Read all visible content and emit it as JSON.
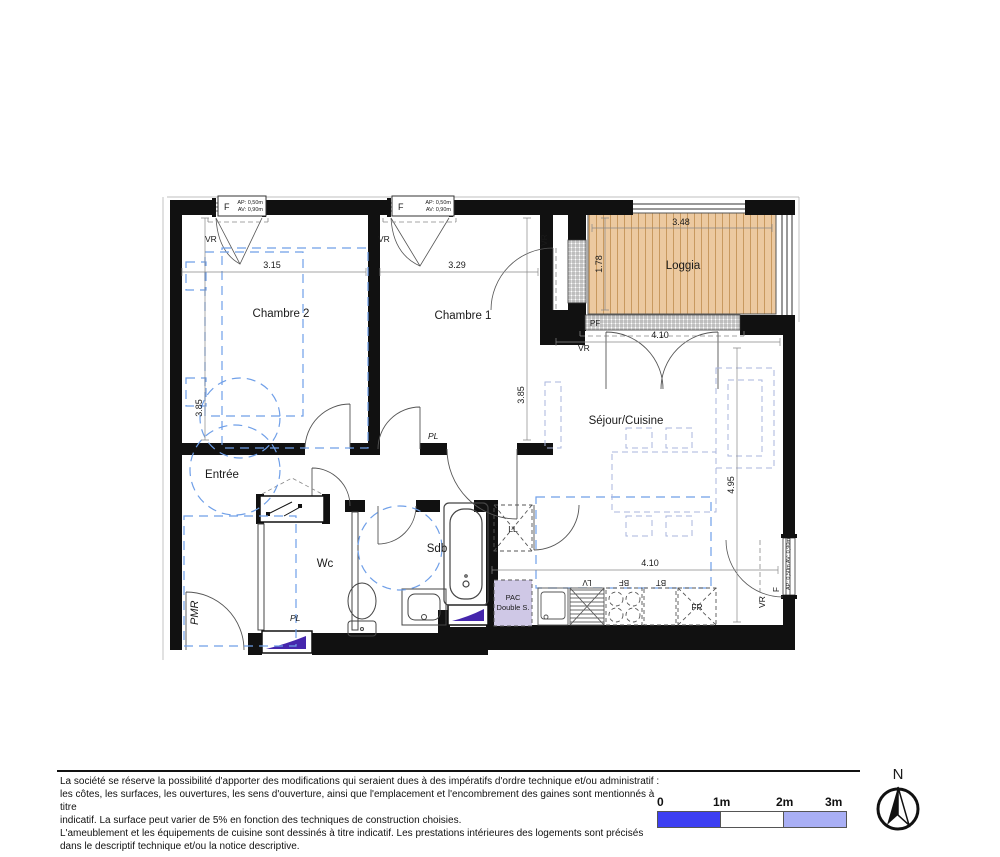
{
  "rooms": {
    "chambre2": "Chambre 2",
    "chambre1": "Chambre 1",
    "loggia": "Loggia",
    "sejour": "Séjour/Cuisine",
    "entree": "Entrée",
    "wc": "Wc",
    "sdb": "Sdb",
    "pmr": "PMR"
  },
  "labels": {
    "pl1": "PL",
    "pl2": "PL",
    "pf": "PF",
    "pac_line1": "PAC",
    "pac_line2": "Double S."
  },
  "appliances": {
    "ll": "LL",
    "lv": "LV",
    "bf": "BF",
    "bt": "BT",
    "fr": "FR"
  },
  "windows": {
    "f": "F",
    "ap": "AP: 0,50m",
    "av": "AV: 0,90m",
    "vr": "VR",
    "side_f": "F",
    "side_spec": "AP: 0,50m AV: 0,90m"
  },
  "dimensions": {
    "chambre2_w": "3.15",
    "chambre1_w": "3.29",
    "chambre2_h": "3.85",
    "chambre1_h": "3.85",
    "loggia_w": "3.48",
    "loggia_h": "1.78",
    "sejour_w": "4.10",
    "sejour_h": "4.95",
    "kitchen_w": "4.10"
  },
  "compass": {
    "north": "N"
  },
  "scalebar": {
    "labels": [
      "0",
      "1m",
      "2m",
      "3m"
    ]
  },
  "colors": {
    "wall": "#111111",
    "wood": "#ecc9a0",
    "wood_stripe": "#c8995f",
    "accent_purple": "#4526ad",
    "pac_fill": "#cfc8e6",
    "dash_blue": "#6f9fe8",
    "furn_dash": "#aab6dd",
    "scale_blue": "#3d3ff2",
    "scale_white": "#ffffff",
    "scale_light": "#a9aff5"
  },
  "disclaimer": {
    "lines": [
      "La société se réserve la possibilité d'apporter des modifications qui seraient dues à des impératifs d'ordre technique et/ou administratif :",
      "les côtes, les surfaces, les ouvertures, les sens d'ouverture, ainsi que l'emplacement et l'encombrement des gaines sont mentionnés à titre",
      "indicatif. La surface peut varier de 5% en fonction des techniques de construction choisies.",
      "L'ameublement et les équipements de cuisine sont dessinés à titre indicatif. Les prestations intérieures des logements sont précisés",
      "dans le descriptif technique et/ou la notice descriptive."
    ]
  }
}
